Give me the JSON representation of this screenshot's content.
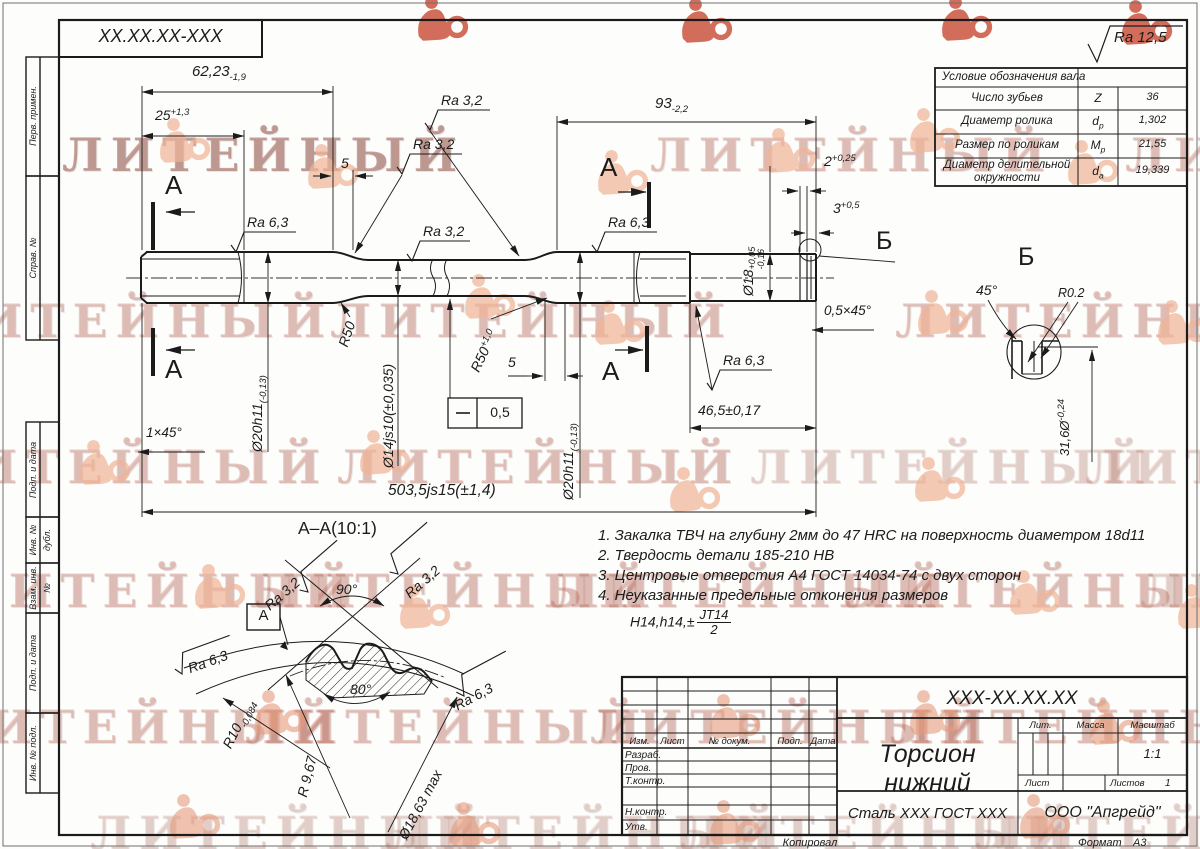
{
  "watermark": {
    "word": "ЛИТЕЙНЫЙ"
  },
  "corner_stamp": {
    "designation": "XX.XX.XX-XXX"
  },
  "general_roughness": {
    "label": "Ra 12,5"
  },
  "spline_table": {
    "title": "Условие обозначения вала",
    "rows": [
      {
        "param": "Число зубьев",
        "symbol": "Z",
        "symbol_sub": "",
        "value": "36"
      },
      {
        "param": "Диаметр ролика",
        "symbol": "d",
        "symbol_sub": "р",
        "value": "1,302"
      },
      {
        "param": "Размер по роликам",
        "symbol": "M",
        "symbol_sub": "р",
        "value": "21,55"
      },
      {
        "param": "Диаметр делительной окружности",
        "symbol": "d",
        "symbol_sub": "а",
        "value": "19,339"
      }
    ]
  },
  "dims": {
    "len1": {
      "main": "62,23",
      "low": "-1,9"
    },
    "len2": {
      "main": "25",
      "high": "+1,3"
    },
    "gap1": "5",
    "len3": {
      "main": "93",
      "low": "-2,2"
    },
    "groove_w": {
      "main": "2",
      "high": "+0,25"
    },
    "groove_p": {
      "main": "3",
      "high": "+0,5"
    },
    "d18": {
      "main": "Ø18",
      "high": "+0,05",
      "low": "-0,16"
    },
    "d20_left": {
      "main": "Ø20h11",
      "low": "(-0,13)"
    },
    "d14": {
      "main": "Ø14js10(±0,035)"
    },
    "d20_right": {
      "main": "Ø20h11",
      "low": "(-0,13)"
    },
    "r50_left": "R50",
    "r50_right": {
      "main": "R50",
      "high": "+1,0"
    },
    "gap2": "5",
    "len_total": "503,5js15(±1,4)",
    "len4": "46,5±0,17",
    "chamfer_left": "1×45°",
    "chamfer_right": "0,5×45°",
    "straightness": "0,5",
    "d_groove": {
      "main": "31,6Ø",
      "high": "-0,24"
    }
  },
  "roughness": {
    "ra32": "Ra 3,2",
    "ra63": "Ra 6,3"
  },
  "sections": {
    "cut_label": "А",
    "section_title": "А–А(10:1)",
    "datum": "А",
    "angle_top": "90°",
    "angle_bottom": "80°",
    "r10": {
      "main": "R10",
      "low": "-0,084"
    },
    "r967": "R 9,67",
    "d_max": "Ø18,63 max",
    "detail_label": "Б",
    "detail_angle": "45°",
    "detail_radius": "R0.2"
  },
  "notes": {
    "lines": [
      "1. Закалка ТВЧ на глубину 2мм до 47 HRC на поверхность диаметром 18d11",
      "2. Твердость детали 185-210 НВ",
      "3. Центровые отверстия А4 ГОСТ 14034-74 с двух сторон",
      "4. Неуказанные предельные отконения размеров"
    ],
    "tol_prefix": "H14,h14,±",
    "tol_num": "JT14",
    "tol_den": "2"
  },
  "title_block": {
    "designation": "XXX-XX.XX.XX",
    "part_name": "Торсион нижний",
    "material": "Сталь XXX ГОСТ XXX",
    "company": "ООО \"Апгрейд\"",
    "scale_value": "1:1",
    "sheets_value": "1",
    "headers": {
      "izm": "Изм.",
      "list": "Лист",
      "doc": "№ докум.",
      "sign": "Подп.",
      "date": "Дата",
      "lit": "Лит.",
      "mass": "Масса",
      "scale": "Масштаб",
      "sheet": "Лист",
      "sheets": "Листов"
    },
    "rows": [
      "Разраб.",
      "Пров.",
      "Т.контр.",
      "Н.контр.",
      "Утв."
    ],
    "footer": {
      "copy": "Копировал",
      "format_label": "Формат",
      "format_value": "А3"
    }
  },
  "margin_stamps": [
    "Перв. примен.",
    "Справ. №",
    "Подп. и дата",
    "Инв. № дубл.",
    "Взам. инв. №",
    "Подп. и дата",
    "Инв. № подл."
  ]
}
